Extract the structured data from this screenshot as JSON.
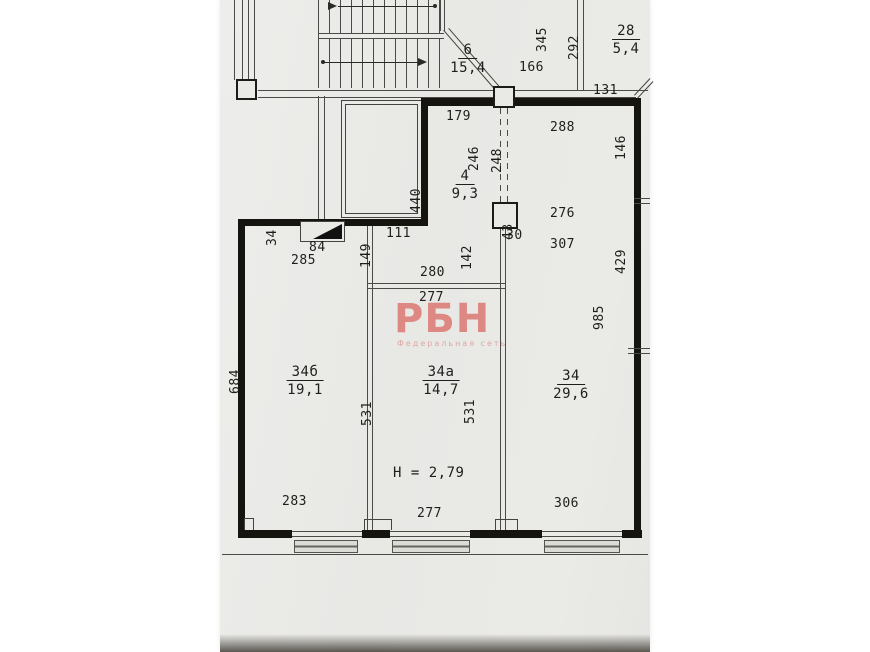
{
  "watermark": {
    "title": "РБН",
    "subtitle": "Федеральная сеть",
    "color": "#d96f6a"
  },
  "paper_color": "#e9e9e6",
  "ink_color": "#1e1e1c",
  "rooms": {
    "stair": {
      "number": "6",
      "area": "15,4"
    },
    "r28": {
      "number": "28",
      "area": "5,4"
    },
    "r4": {
      "number": "4",
      "area": "9,3"
    },
    "r34b": {
      "number": "34б",
      "area": "19,1"
    },
    "r34a": {
      "number": "34а",
      "area": "14,7"
    },
    "r34": {
      "number": "34",
      "area": "29,6"
    }
  },
  "height_label": "H = 2,79",
  "dims": {
    "d166": "166",
    "d131": "131",
    "d179": "179",
    "d288": "288",
    "d345": "345",
    "d292": "292",
    "d146": "146",
    "d429": "429",
    "d440": "440",
    "d246": "246",
    "d248": "248",
    "d43": "43",
    "d30": "30",
    "d276": "276",
    "d307": "307",
    "d142": "142",
    "d111": "111",
    "d149": "149",
    "d280": "280",
    "d277_mid": "277",
    "d285": "285",
    "d84": "84",
    "d34_vent": "34",
    "d684": "684",
    "d531_left": "531",
    "d531_right": "531",
    "d985": "985",
    "d283": "283",
    "d277_bottom": "277",
    "d306": "306"
  }
}
